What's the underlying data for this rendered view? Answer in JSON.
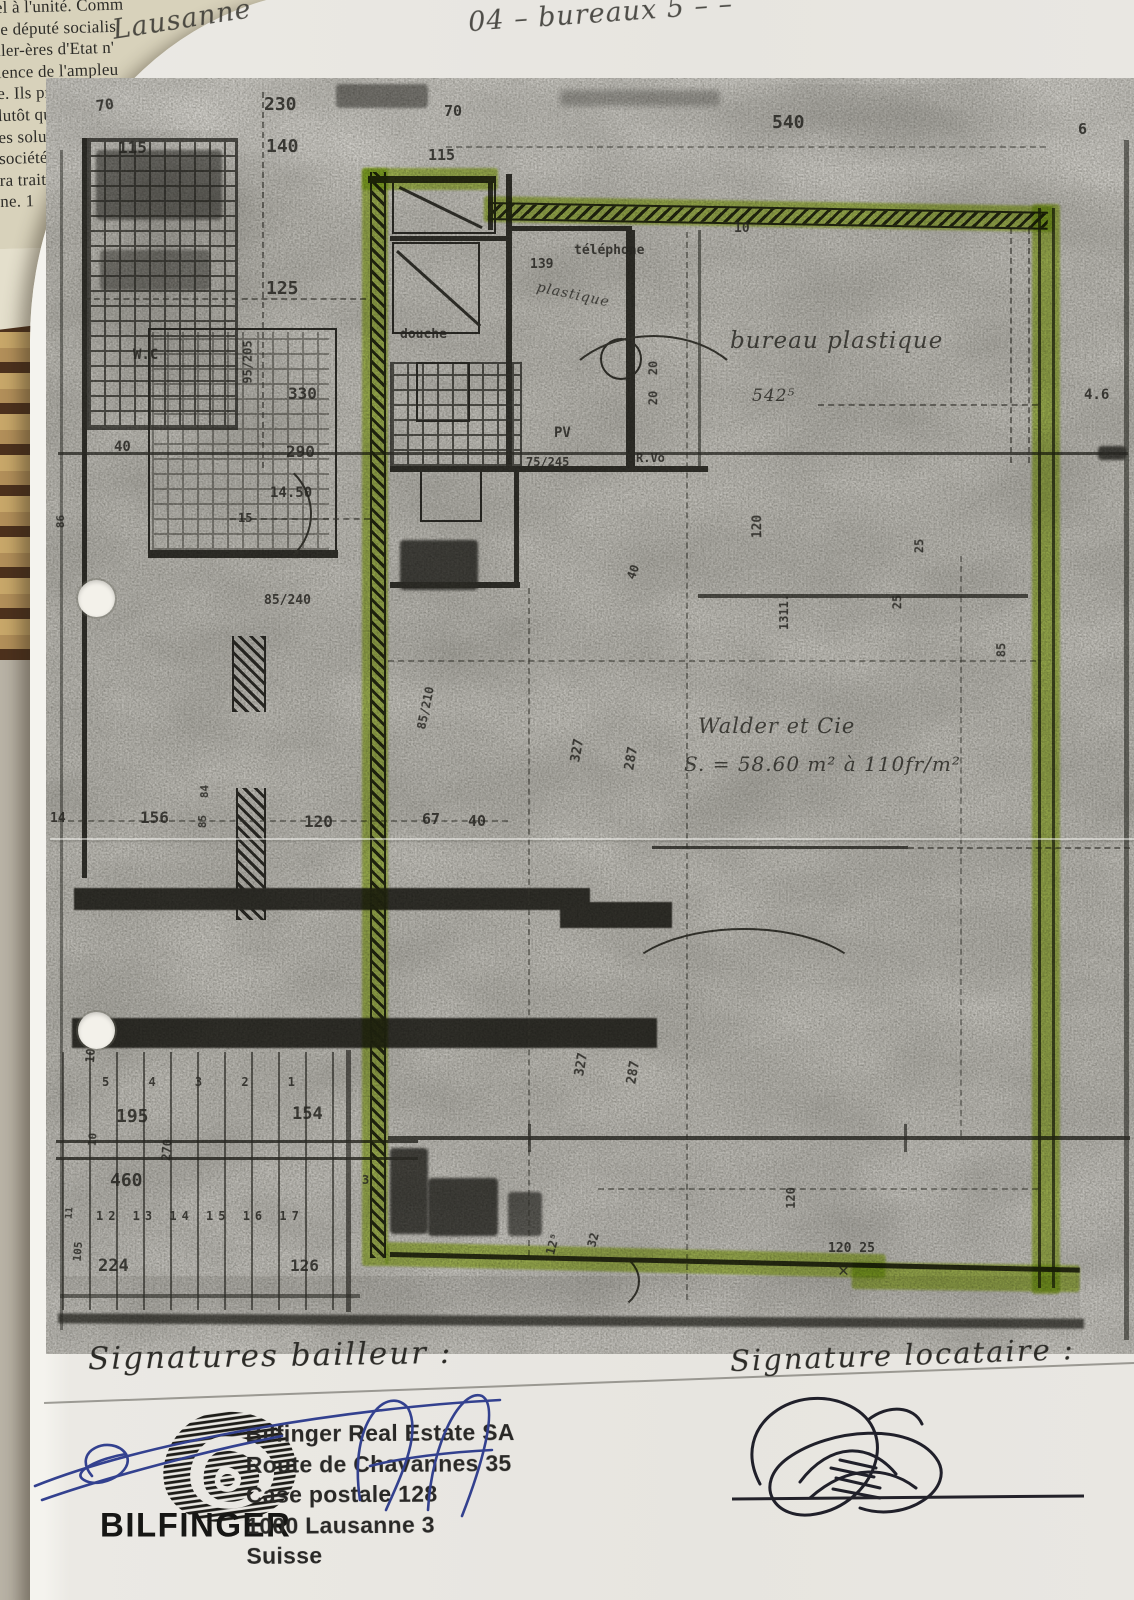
{
  "newspaper": {
    "lines": [
      "el à l'unité. Comm",
      "le député socialis",
      "ller-ères d'Etat n'",
      "ience de l'ampleu",
      "e. Ils préfèrent f",
      "lutôt que de te",
      "es solutions e",
      "société». Il e",
      "ra traité r",
      "ne. 1"
    ]
  },
  "handwriting": {
    "city": "Lausanne",
    "top_note": "04 – bureaux 5 – –",
    "bailleur_label": "Signatures bailleur :",
    "locataire_label": "Signature locataire :"
  },
  "stamp": {
    "logo_text": "BILFINGER",
    "lines": [
      "Bilfinger Real Estate SA",
      "Route de Chavannes 35",
      "Case postale 128",
      "1000 Lausanne 3",
      "Suisse"
    ]
  },
  "colors": {
    "highlighter": "#b5d63c",
    "paper": "#e9e7e2",
    "plan_gray": "#c9c7c1",
    "pen_blue": "#33418f",
    "pen_black": "#20202a"
  },
  "plan": {
    "tenant": "Walder et Cie",
    "area_note": "S. = 58.60 m² à 110fr/m²",
    "room_label": "bureau plastique",
    "labels": [
      {
        "t": "Lausanne",
        "x": 112,
        "y": 6,
        "s": 27,
        "r": -9,
        "c": "hand",
        "n": "handwritten-city"
      },
      {
        "t": "04 – bureaux 5 – –",
        "x": 468,
        "y": 0,
        "s": 27,
        "r": -4,
        "c": "hand",
        "n": "handwritten-note"
      },
      {
        "t": "70",
        "x": 96,
        "y": 98,
        "s": 15,
        "r": -8
      },
      {
        "t": "230",
        "x": 264,
        "y": 96,
        "s": 18
      },
      {
        "t": "140",
        "x": 266,
        "y": 138,
        "s": 18
      },
      {
        "t": "115",
        "x": 118,
        "y": 140,
        "s": 16
      },
      {
        "t": "70",
        "x": 444,
        "y": 104,
        "s": 15
      },
      {
        "t": "115",
        "x": 428,
        "y": 148,
        "s": 15
      },
      {
        "t": "540",
        "x": 772,
        "y": 114,
        "s": 18
      },
      {
        "t": "6",
        "x": 1078,
        "y": 122,
        "s": 15
      },
      {
        "t": "10",
        "x": 734,
        "y": 222,
        "s": 13
      },
      {
        "t": "139",
        "x": 530,
        "y": 258,
        "s": 13
      },
      {
        "t": "téléphone",
        "x": 574,
        "y": 244,
        "s": 13
      },
      {
        "t": "plastique",
        "x": 536,
        "y": 288,
        "s": 14,
        "r": 12,
        "c": "hand"
      },
      {
        "t": "douche",
        "x": 400,
        "y": 328,
        "s": 13
      },
      {
        "t": "125",
        "x": 266,
        "y": 280,
        "s": 18
      },
      {
        "t": "W.C",
        "x": 133,
        "y": 348,
        "s": 14
      },
      {
        "t": "95/205",
        "x": 226,
        "y": 356,
        "s": 12,
        "r": -90
      },
      {
        "t": "330",
        "x": 288,
        "y": 386,
        "s": 16
      },
      {
        "t": "290",
        "x": 286,
        "y": 444,
        "s": 16
      },
      {
        "t": "14.50",
        "x": 270,
        "y": 486,
        "s": 14
      },
      {
        "t": "40",
        "x": 114,
        "y": 440,
        "s": 14
      },
      {
        "t": "15",
        "x": 238,
        "y": 512,
        "s": 12
      },
      {
        "t": "86",
        "x": 54,
        "y": 516,
        "s": 11,
        "r": -90
      },
      {
        "t": "85/240",
        "x": 264,
        "y": 594,
        "s": 13
      },
      {
        "t": "PV",
        "x": 554,
        "y": 426,
        "s": 14
      },
      {
        "t": "75/245",
        "x": 526,
        "y": 456,
        "s": 12
      },
      {
        "t": "R.Vo",
        "x": 636,
        "y": 452,
        "s": 12
      },
      {
        "t": "20",
        "x": 646,
        "y": 362,
        "s": 12,
        "r": -90
      },
      {
        "t": "20",
        "x": 646,
        "y": 392,
        "s": 12,
        "r": -90
      },
      {
        "t": "bureau  plastique",
        "x": 730,
        "y": 330,
        "s": 23,
        "c": "hand",
        "n": "room-label-bureau-plastique"
      },
      {
        "t": "542⁵",
        "x": 752,
        "y": 388,
        "s": 17,
        "c": "hand"
      },
      {
        "t": "4.6",
        "x": 1084,
        "y": 388,
        "s": 14
      },
      {
        "t": "120",
        "x": 746,
        "y": 520,
        "s": 13,
        "r": -90
      },
      {
        "t": "40",
        "x": 626,
        "y": 566,
        "s": 12,
        "r": -70
      },
      {
        "t": "25",
        "x": 912,
        "y": 540,
        "s": 12,
        "r": -90
      },
      {
        "t": "25",
        "x": 890,
        "y": 596,
        "s": 12,
        "r": -90
      },
      {
        "t": "85",
        "x": 994,
        "y": 644,
        "s": 12,
        "r": -90
      },
      {
        "t": "1311.",
        "x": 766,
        "y": 606,
        "s": 12,
        "r": -90
      },
      {
        "t": "327",
        "x": 566,
        "y": 744,
        "s": 13,
        "r": -80
      },
      {
        "t": "287",
        "x": 620,
        "y": 752,
        "s": 13,
        "r": -80
      },
      {
        "t": "85/210",
        "x": 404,
        "y": 702,
        "s": 12,
        "r": -78
      },
      {
        "t": "Walder   et   Cie",
        "x": 698,
        "y": 716,
        "s": 21,
        "c": "hand",
        "n": "tenant-name"
      },
      {
        "t": "S. = 58.60 m²  à  110fr/m²",
        "x": 684,
        "y": 754,
        "s": 20,
        "c": "hand",
        "n": "area-price-note"
      },
      {
        "t": "14",
        "x": 50,
        "y": 812,
        "s": 13
      },
      {
        "t": "156",
        "x": 140,
        "y": 810,
        "s": 16
      },
      {
        "t": "84",
        "x": 198,
        "y": 786,
        "s": 11,
        "r": -90
      },
      {
        "t": "85",
        "x": 196,
        "y": 816,
        "s": 11,
        "r": -90
      },
      {
        "t": "120",
        "x": 304,
        "y": 814,
        "s": 16
      },
      {
        "t": "67",
        "x": 422,
        "y": 812,
        "s": 15
      },
      {
        "t": "40",
        "x": 468,
        "y": 814,
        "s": 15
      },
      {
        "t": "105",
        "x": 80,
        "y": 1046,
        "s": 12,
        "r": -85
      },
      {
        "t": "5 4 3 2 1",
        "x": 102,
        "y": 1076,
        "s": 12,
        "ls": 16
      },
      {
        "t": "195",
        "x": 116,
        "y": 1108,
        "s": 18
      },
      {
        "t": "154",
        "x": 292,
        "y": 1106,
        "s": 17
      },
      {
        "t": "10",
        "x": 86,
        "y": 1134,
        "s": 11,
        "r": -85
      },
      {
        "t": "270",
        "x": 156,
        "y": 1144,
        "s": 12,
        "r": -85
      },
      {
        "t": "460",
        "x": 110,
        "y": 1172,
        "s": 18
      },
      {
        "t": "11",
        "x": 64,
        "y": 1208,
        "s": 10,
        "r": -85
      },
      {
        "t": "12 13 14 15 16 17",
        "x": 96,
        "y": 1210,
        "s": 12,
        "ls": 5
      },
      {
        "t": "105",
        "x": 68,
        "y": 1246,
        "s": 11,
        "r": -85
      },
      {
        "t": "224",
        "x": 98,
        "y": 1258,
        "s": 17
      },
      {
        "t": "126",
        "x": 290,
        "y": 1258,
        "s": 16
      },
      {
        "t": "3",
        "x": 362,
        "y": 1174,
        "s": 12
      },
      {
        "t": "327",
        "x": 570,
        "y": 1058,
        "s": 13,
        "r": -80
      },
      {
        "t": "287",
        "x": 622,
        "y": 1066,
        "s": 13,
        "r": -80
      },
      {
        "t": "120",
        "x": 780,
        "y": 1192,
        "s": 12,
        "r": -90
      },
      {
        "t": "12⁵",
        "x": 542,
        "y": 1238,
        "s": 12,
        "r": -75
      },
      {
        "t": "32",
        "x": 586,
        "y": 1234,
        "s": 12,
        "r": -75
      },
      {
        "t": "120 25",
        "x": 828,
        "y": 1242,
        "s": 13
      },
      {
        "t": "✕",
        "x": 838,
        "y": 1262,
        "s": 18,
        "n": "x-mark"
      }
    ]
  }
}
